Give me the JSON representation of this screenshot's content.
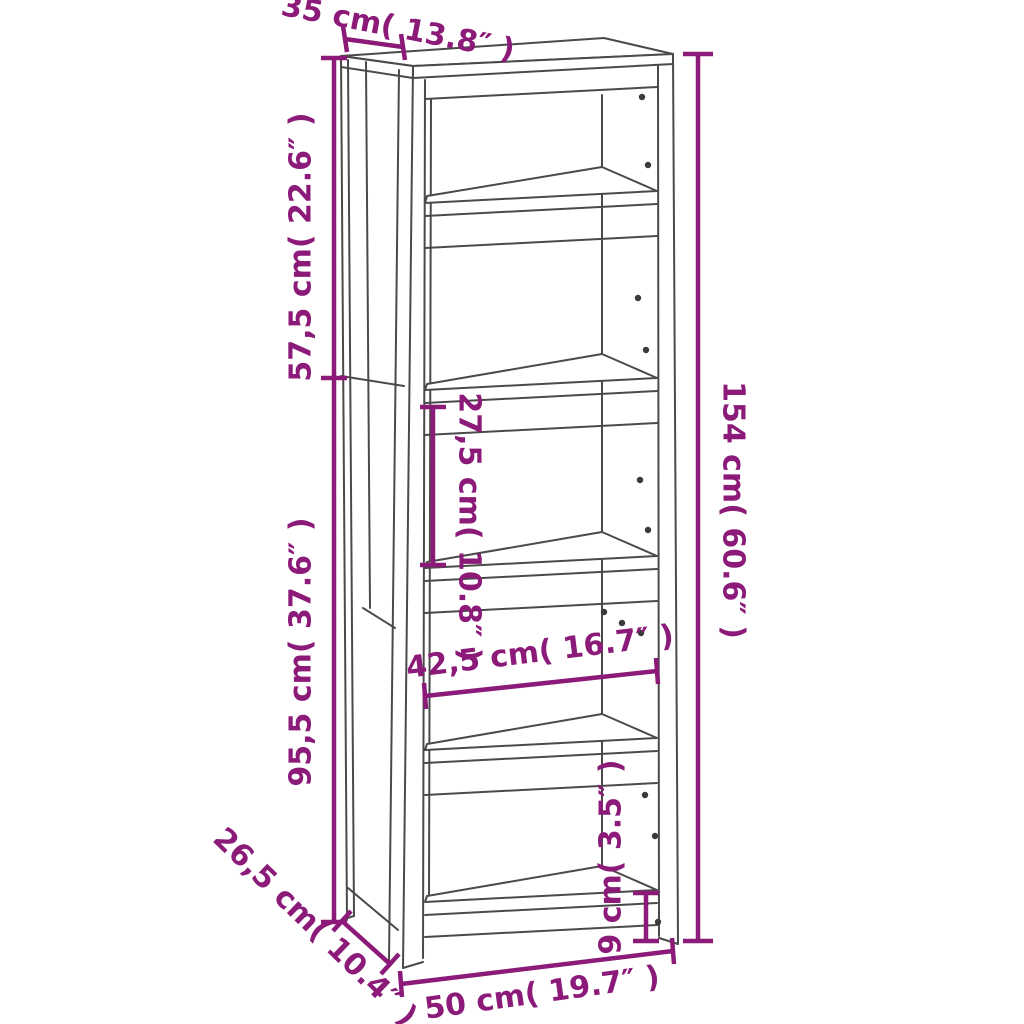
{
  "diagram": {
    "title": "bookcase-dimension-diagram",
    "dimensions": {
      "depth_top": "35 cm( 13.8″ )",
      "upper_section_height": "57,5 cm( 22.6″ )",
      "lower_section_height": "95,5 cm( 37.6″ )",
      "shelf_gap": "27,5 cm( 10.8″ )",
      "total_height": "154 cm( 60.6″ )",
      "inner_width": "42,5 cm( 16.7″ )",
      "depth_lower": "26,5 cm( 10.4″ )",
      "base_height": "9 cm( 3.5″ )",
      "total_width": "50 cm( 19.7″ )"
    },
    "colors": {
      "dimension": "#8b1a79",
      "line": "#4a4a4a",
      "background": "#ffffff"
    }
  }
}
